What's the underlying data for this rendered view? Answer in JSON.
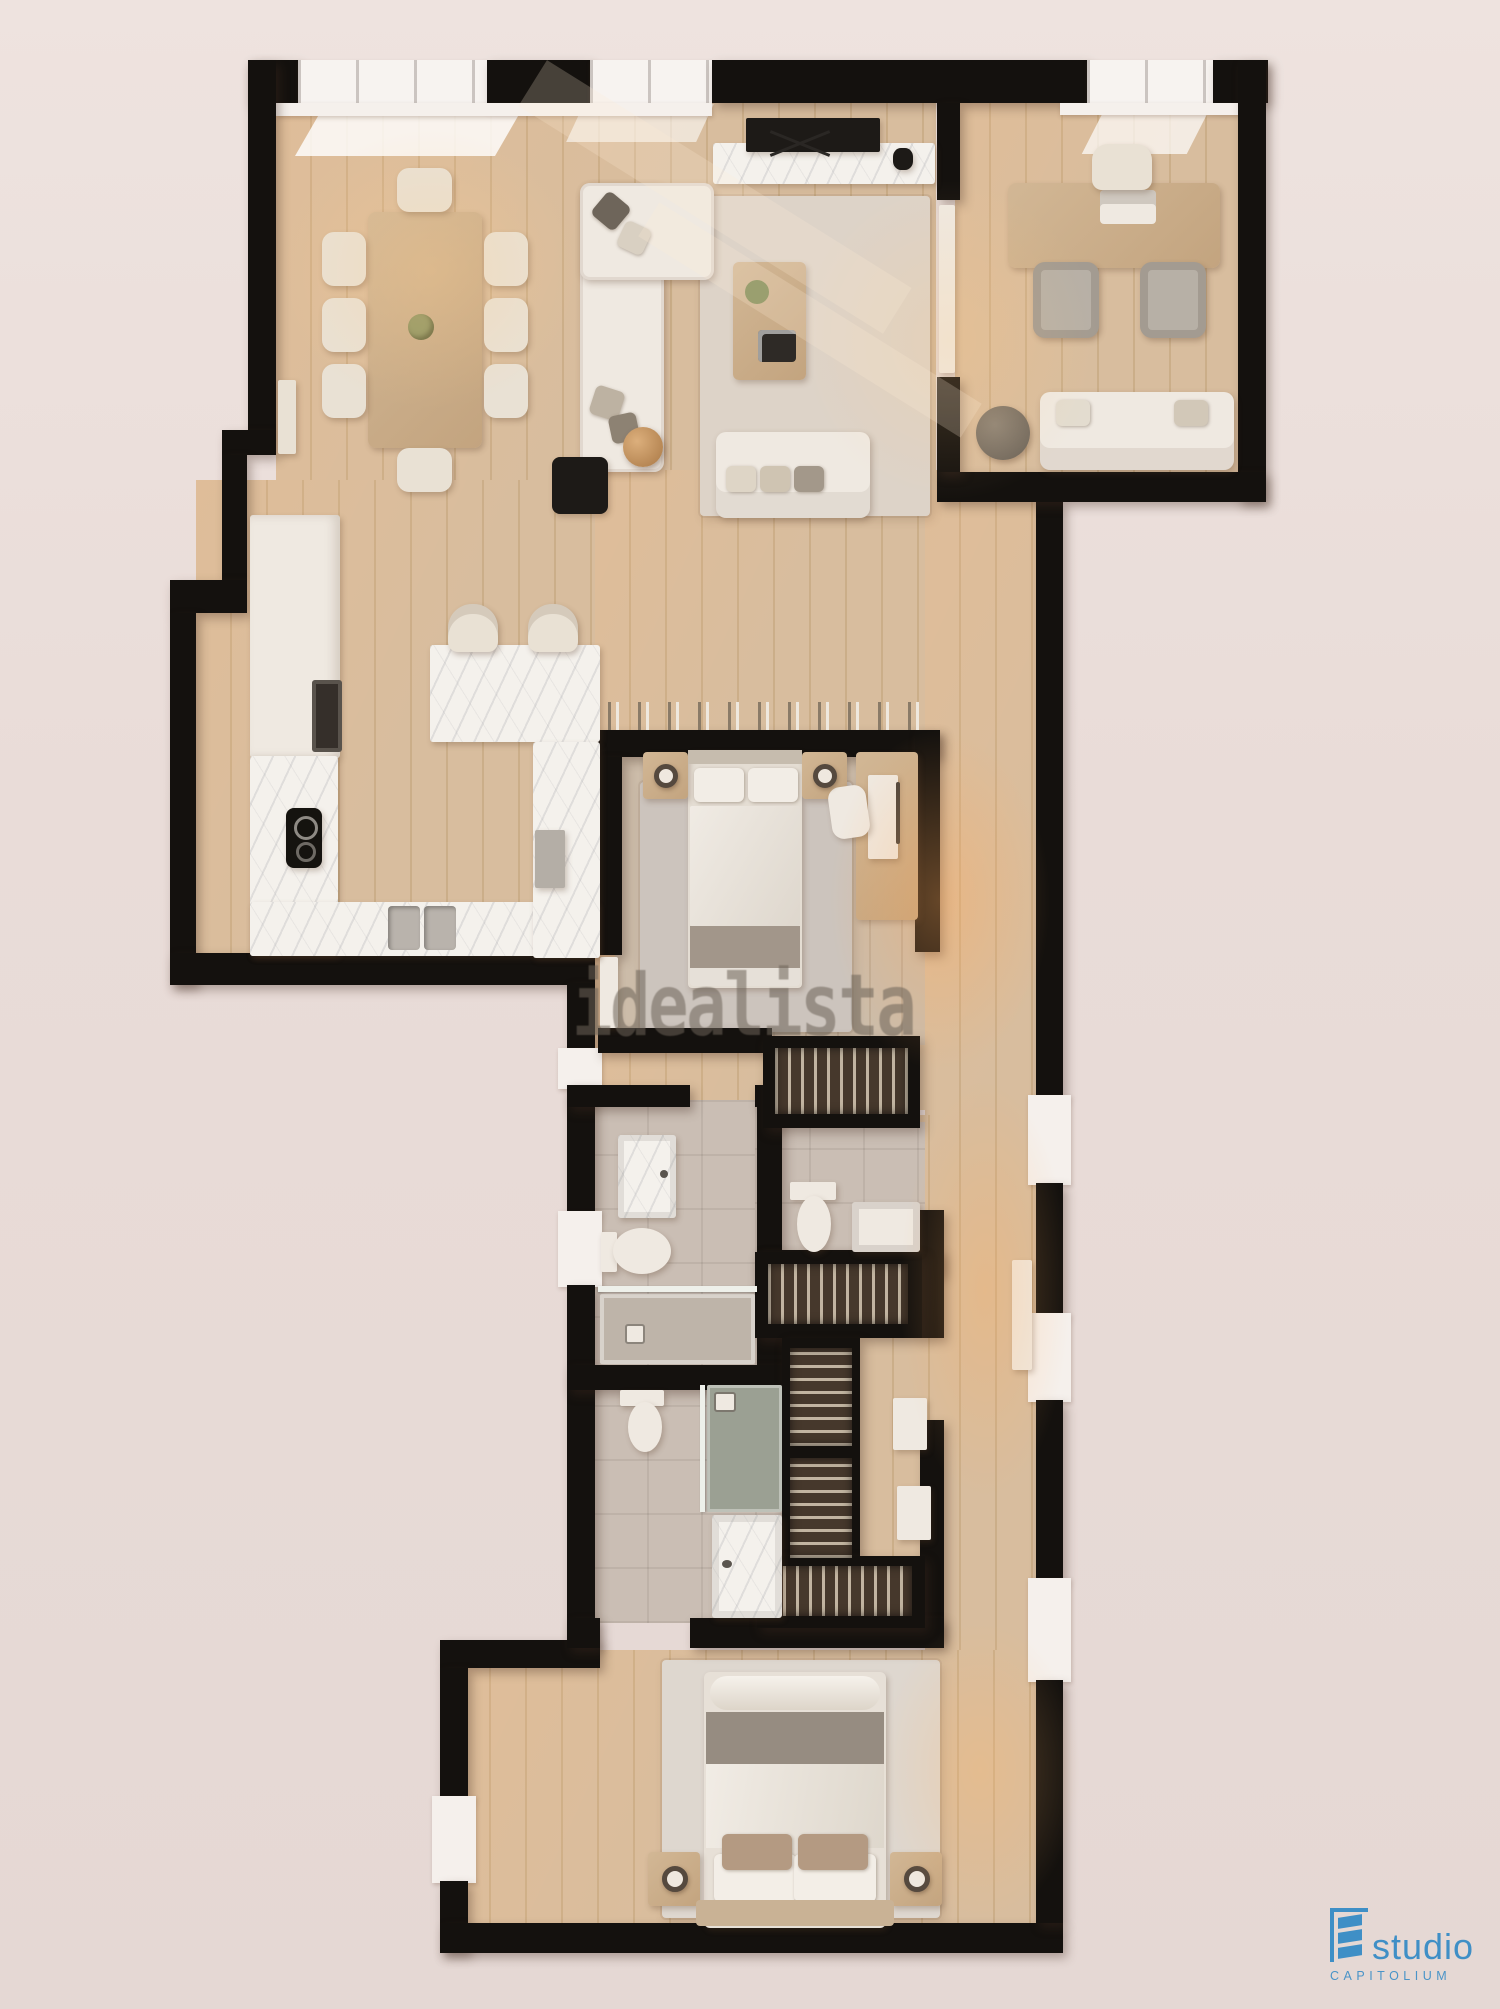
{
  "watermark": {
    "text": "idealista"
  },
  "logo": {
    "name": "studio",
    "subname": "CAPITOLIUM",
    "accent_color": "#3f8fc6"
  },
  "palette": {
    "background": "#e9dcd8",
    "walls": "#14110e",
    "wood_floor": "#d6bb9a",
    "bedroom_floor": "#c9b9a6",
    "tile_floor": "#cabeb4",
    "marble": "#f4f1ec",
    "furniture_light": "#efe9e1",
    "furniture_wood": "#cdb292",
    "rug": "#ddd3c8",
    "wardrobe_interior": "#46382c",
    "shower_tray": "#9ba093",
    "warm_light": "#ffb070"
  },
  "rooms": [
    {
      "id": "living-dining",
      "furniture": [
        "dining-table",
        "dining-chairs-x8",
        "corner-sofa",
        "straight-sofa",
        "coffee-table",
        "area-rug",
        "tv",
        "tv-console",
        "black-side-table",
        "round-lamp-table",
        "bay-windows"
      ]
    },
    {
      "id": "office",
      "furniture": [
        "desk",
        "desk-chair",
        "visitor-chairs-x2",
        "laptop",
        "sofa",
        "round-side-table",
        "window"
      ]
    },
    {
      "id": "kitchen",
      "furniture": [
        "tall-cabinets",
        "oven",
        "cooktop",
        "double-sink",
        "u-shaped-counter",
        "breakfast-bar",
        "bar-stools-x2",
        "dishwasher"
      ]
    },
    {
      "id": "bedroom-1",
      "furniture": [
        "double-bed",
        "nightstands-x2",
        "table-lamps-x2",
        "desk",
        "desk-chair",
        "area-rug",
        "bookshelf"
      ]
    },
    {
      "id": "bathroom-1",
      "furniture": [
        "vanity-sink",
        "toilet",
        "walk-in-shower"
      ]
    },
    {
      "id": "toilet-room",
      "furniture": [
        "toilet",
        "washbasin"
      ]
    },
    {
      "id": "walk-in-closet",
      "furniture": [
        "wardrobes-x5",
        "linen-shelves"
      ]
    },
    {
      "id": "en-suite-bathroom",
      "furniture": [
        "toilet",
        "shower",
        "marble-vanity"
      ]
    },
    {
      "id": "master-bedroom",
      "furniture": [
        "double-bed",
        "nightstands-x2",
        "table-lamps-x2",
        "area-rug"
      ]
    },
    {
      "id": "corridor",
      "furniture": [
        "entrance-door",
        "windows"
      ]
    }
  ]
}
